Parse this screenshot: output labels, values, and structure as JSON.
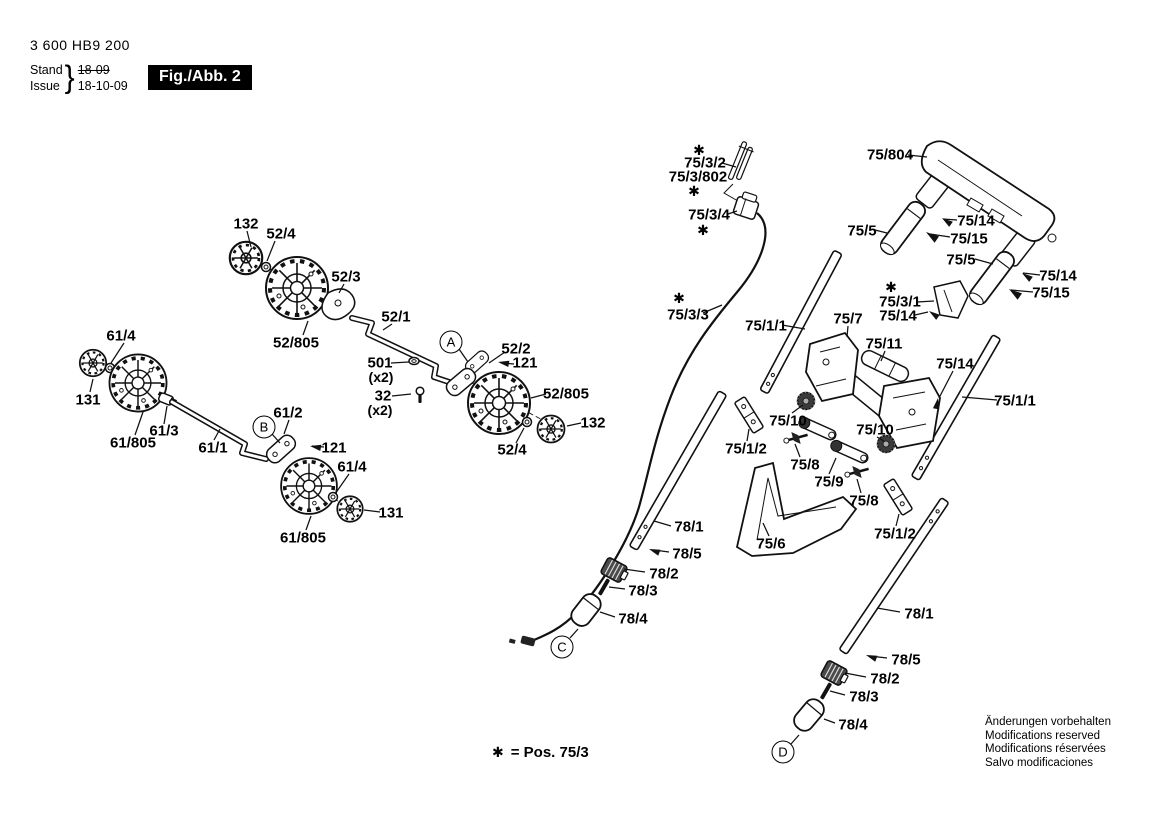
{
  "header": {
    "part_number": "3 600 HB9 200",
    "stand_label": "Stand",
    "issue_label": "Issue",
    "brace": "}",
    "stand_value": "18-09",
    "issue_value": "18-10-09",
    "figure_box": "Fig./Abb. 2"
  },
  "footnote": {
    "star": "✱",
    "text": "= Pos. 75/3"
  },
  "legal": {
    "lines": [
      "Änderungen vorbehalten",
      "Modifications reserved",
      "Modifications réservées",
      "Salvo modificaciones"
    ]
  },
  "labels": [
    {
      "text": "132",
      "x": 246,
      "y": 224,
      "kind": "part"
    },
    {
      "text": "52/4",
      "x": 281,
      "y": 234,
      "kind": "part"
    },
    {
      "text": "52/3",
      "x": 346,
      "y": 277,
      "kind": "part"
    },
    {
      "text": "52/1",
      "x": 396,
      "y": 317,
      "kind": "part"
    },
    {
      "text": "52/805",
      "x": 296,
      "y": 343,
      "kind": "part"
    },
    {
      "text": "61/4",
      "x": 121,
      "y": 336,
      "kind": "part"
    },
    {
      "text": "131",
      "x": 88,
      "y": 400,
      "kind": "part"
    },
    {
      "text": "61/805",
      "x": 133,
      "y": 443,
      "kind": "part"
    },
    {
      "text": "61/3",
      "x": 164,
      "y": 431,
      "kind": "part"
    },
    {
      "text": "61/1",
      "x": 213,
      "y": 448,
      "kind": "part"
    },
    {
      "text": "61/2",
      "x": 288,
      "y": 413,
      "kind": "part"
    },
    {
      "text": "B",
      "x": 264,
      "y": 427,
      "kind": "ref"
    },
    {
      "text": "121",
      "x": 334,
      "y": 448,
      "kind": "part"
    },
    {
      "text": "61/4",
      "x": 352,
      "y": 467,
      "kind": "part"
    },
    {
      "text": "131",
      "x": 391,
      "y": 513,
      "kind": "part"
    },
    {
      "text": "61/805",
      "x": 303,
      "y": 538,
      "kind": "part"
    },
    {
      "text": "A",
      "x": 451,
      "y": 342,
      "kind": "ref"
    },
    {
      "text": "52/2",
      "x": 516,
      "y": 349,
      "kind": "part"
    },
    {
      "text": "121",
      "x": 525,
      "y": 363,
      "kind": "part"
    },
    {
      "text": "501",
      "x": 380,
      "y": 363,
      "kind": "part"
    },
    {
      "text": "(x2)",
      "x": 381,
      "y": 377,
      "kind": "qty"
    },
    {
      "text": "32",
      "x": 383,
      "y": 396,
      "kind": "part"
    },
    {
      "text": "(x2)",
      "x": 380,
      "y": 410,
      "kind": "qty"
    },
    {
      "text": "52/805",
      "x": 566,
      "y": 394,
      "kind": "part"
    },
    {
      "text": "132",
      "x": 593,
      "y": 423,
      "kind": "part"
    },
    {
      "text": "52/4",
      "x": 512,
      "y": 450,
      "kind": "part"
    },
    {
      "text": "✱",
      "x": 699,
      "y": 150,
      "kind": "star"
    },
    {
      "text": "75/3/2",
      "x": 705,
      "y": 163,
      "kind": "part"
    },
    {
      "text": "75/3/802",
      "x": 698,
      "y": 177,
      "kind": "part"
    },
    {
      "text": "✱",
      "x": 694,
      "y": 191,
      "kind": "star"
    },
    {
      "text": "75/3/4",
      "x": 709,
      "y": 215,
      "kind": "part"
    },
    {
      "text": "✱",
      "x": 703,
      "y": 230,
      "kind": "star"
    },
    {
      "text": "75/804",
      "x": 890,
      "y": 155,
      "kind": "part"
    },
    {
      "text": "75/14",
      "x": 976,
      "y": 221,
      "kind": "part"
    },
    {
      "text": "75/15",
      "x": 969,
      "y": 239,
      "kind": "part"
    },
    {
      "text": "75/5",
      "x": 862,
      "y": 231,
      "kind": "part"
    },
    {
      "text": "75/5",
      "x": 961,
      "y": 260,
      "kind": "part"
    },
    {
      "text": "75/14",
      "x": 1058,
      "y": 276,
      "kind": "part"
    },
    {
      "text": "75/15",
      "x": 1051,
      "y": 293,
      "kind": "part"
    },
    {
      "text": "✱",
      "x": 891,
      "y": 287,
      "kind": "star"
    },
    {
      "text": "75/3/1",
      "x": 900,
      "y": 302,
      "kind": "part"
    },
    {
      "text": "75/14",
      "x": 898,
      "y": 316,
      "kind": "part"
    },
    {
      "text": "✱",
      "x": 679,
      "y": 298,
      "kind": "star"
    },
    {
      "text": "75/3/3",
      "x": 688,
      "y": 315,
      "kind": "part"
    },
    {
      "text": "75/1/1",
      "x": 766,
      "y": 326,
      "kind": "part"
    },
    {
      "text": "75/7",
      "x": 848,
      "y": 319,
      "kind": "part"
    },
    {
      "text": "75/11",
      "x": 884,
      "y": 344,
      "kind": "part"
    },
    {
      "text": "75/14",
      "x": 955,
      "y": 364,
      "kind": "part"
    },
    {
      "text": "75/1/1",
      "x": 1015,
      "y": 401,
      "kind": "part"
    },
    {
      "text": "75/10",
      "x": 788,
      "y": 421,
      "kind": "part"
    },
    {
      "text": "75/10",
      "x": 875,
      "y": 430,
      "kind": "part"
    },
    {
      "text": "75/1/2",
      "x": 746,
      "y": 449,
      "kind": "part"
    },
    {
      "text": "75/8",
      "x": 805,
      "y": 465,
      "kind": "part"
    },
    {
      "text": "75/9",
      "x": 829,
      "y": 482,
      "kind": "part"
    },
    {
      "text": "75/8",
      "x": 864,
      "y": 501,
      "kind": "part"
    },
    {
      "text": "75/6",
      "x": 771,
      "y": 544,
      "kind": "part"
    },
    {
      "text": "75/1/2",
      "x": 895,
      "y": 534,
      "kind": "part"
    },
    {
      "text": "78/1",
      "x": 689,
      "y": 527,
      "kind": "part"
    },
    {
      "text": "78/5",
      "x": 687,
      "y": 554,
      "kind": "part"
    },
    {
      "text": "78/2",
      "x": 664,
      "y": 574,
      "kind": "part"
    },
    {
      "text": "78/3",
      "x": 643,
      "y": 591,
      "kind": "part"
    },
    {
      "text": "78/4",
      "x": 633,
      "y": 619,
      "kind": "part"
    },
    {
      "text": "C",
      "x": 562,
      "y": 647,
      "kind": "ref"
    },
    {
      "text": "78/1",
      "x": 919,
      "y": 614,
      "kind": "part"
    },
    {
      "text": "78/5",
      "x": 906,
      "y": 660,
      "kind": "part"
    },
    {
      "text": "78/2",
      "x": 885,
      "y": 679,
      "kind": "part"
    },
    {
      "text": "78/3",
      "x": 864,
      "y": 697,
      "kind": "part"
    },
    {
      "text": "78/4",
      "x": 853,
      "y": 725,
      "kind": "part"
    },
    {
      "text": "D",
      "x": 783,
      "y": 752,
      "kind": "ref"
    }
  ]
}
